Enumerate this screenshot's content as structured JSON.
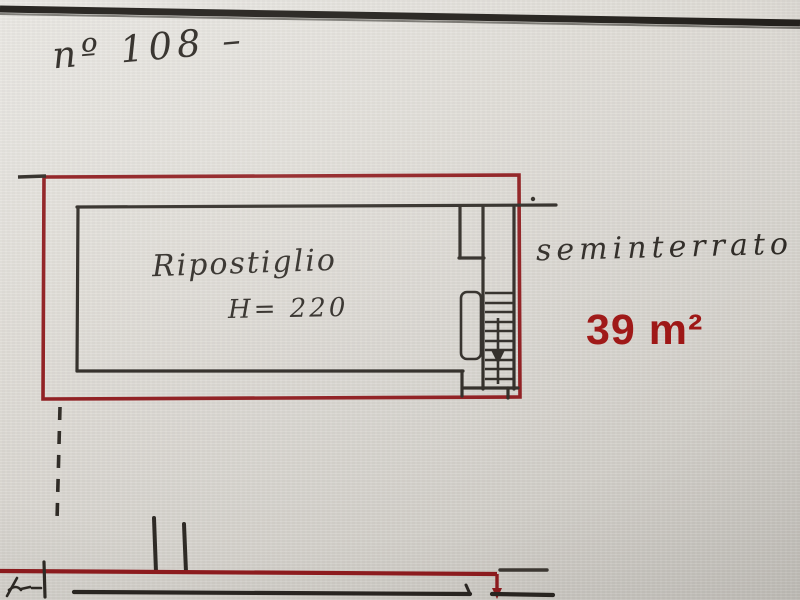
{
  "annotations": {
    "plan_number": "nº 108 –",
    "room": {
      "name": "Ripostiglio",
      "height_label": "H= 220"
    },
    "floor_label": "seminterrato",
    "area_label": "39 m²"
  },
  "drawing": {
    "red_boundary": "unit perimeter highlighted in red",
    "staircase": "stair treads with down arrow at right side of room",
    "dashed_line": "dashed boundary line below unit",
    "scribble": "handwritten mark at bottom left"
  },
  "colors": {
    "paper": "#d9d6d0",
    "ink": "#2e2a25",
    "red_outline": "#8e1b1e",
    "red_text": "#9d1413"
  }
}
